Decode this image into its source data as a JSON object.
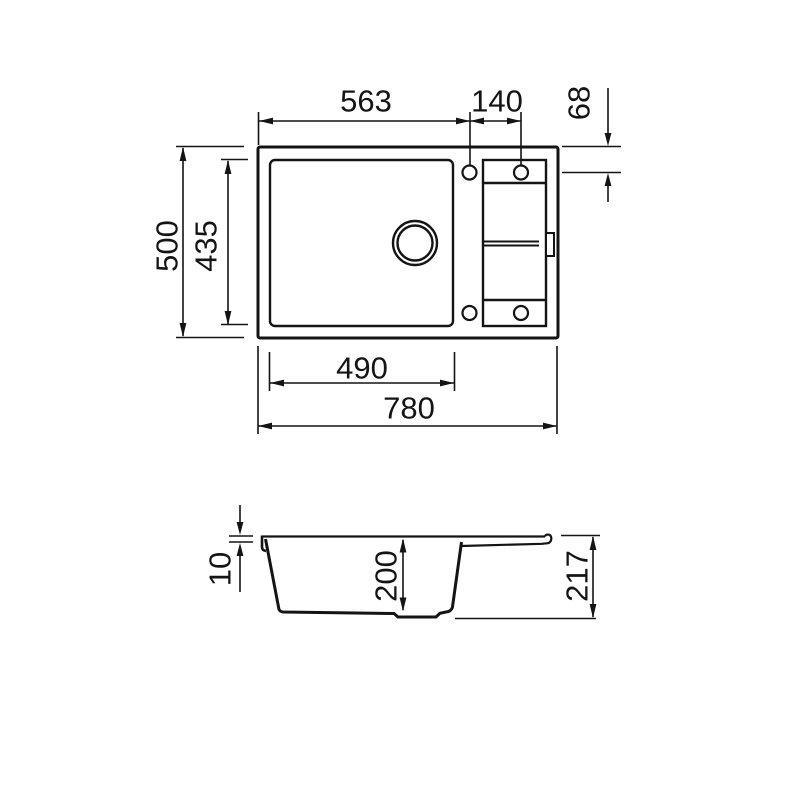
{
  "drawing": {
    "background": "#ffffff",
    "line_color": "#141414",
    "top_view": {
      "dims": {
        "rim_to_hole1": "563",
        "hole_spacing": "140",
        "hole_edge_offset": "68",
        "overall_depth": "500",
        "bowl_depth": "435",
        "bowl_width": "490",
        "overall_width": "780"
      }
    },
    "section_view": {
      "dims": {
        "rim_thickness": "10",
        "bowl_inner_depth": "200",
        "overall_height": "217"
      }
    }
  }
}
